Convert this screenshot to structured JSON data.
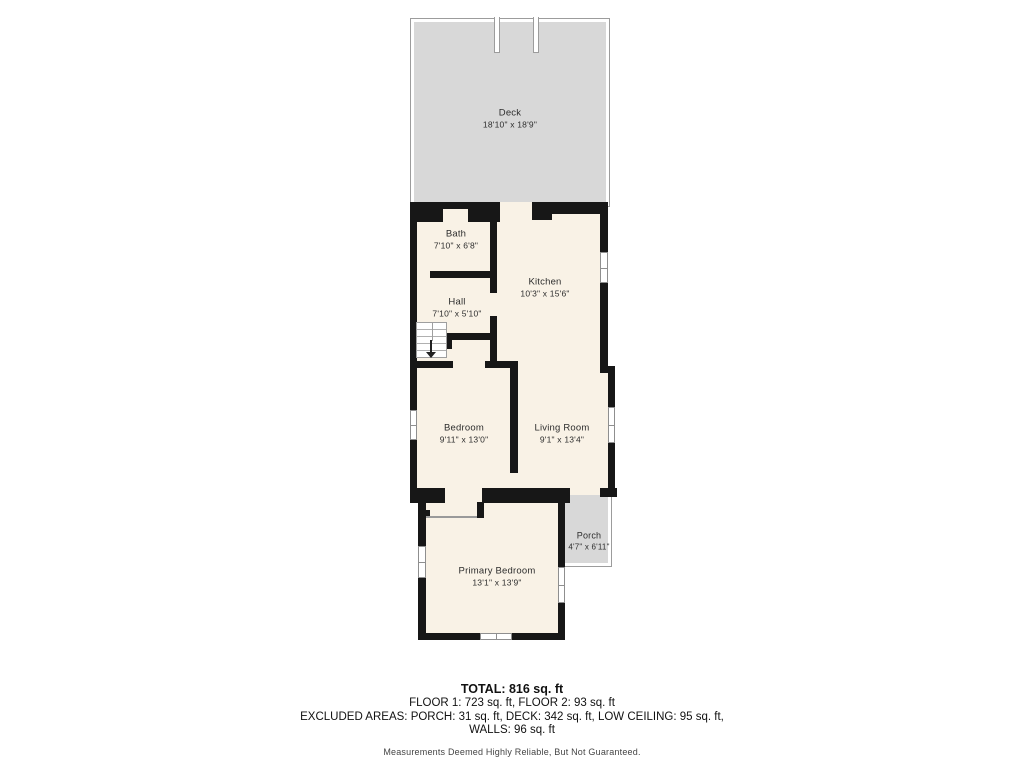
{
  "rooms": {
    "deck": {
      "name": "Deck",
      "dims": "18'10\" x 18'9\""
    },
    "bath": {
      "name": "Bath",
      "dims": "7'10\" x 6'8\""
    },
    "kitchen": {
      "name": "Kitchen",
      "dims": "10'3\" x 15'6\""
    },
    "hall": {
      "name": "Hall",
      "dims": "7'10\" x 5'10\""
    },
    "bedroom": {
      "name": "Bedroom",
      "dims": "9'11\" x 13'0\""
    },
    "living": {
      "name": "Living Room",
      "dims": "9'1\" x 13'4\""
    },
    "porch": {
      "name": "Porch",
      "dims": "4'7\" x 6'11\""
    },
    "primary": {
      "name": "Primary Bedroom",
      "dims": "13'1\" x 13'9\""
    }
  },
  "summary": {
    "total": "TOTAL: 816 sq. ft",
    "floors": "FLOOR 1: 723 sq. ft, FLOOR 2: 93 sq. ft",
    "excluded_line1": "EXCLUDED AREAS: PORCH: 31 sq. ft, DECK: 342 sq. ft, LOW CEILING: 95 sq. ft,",
    "excluded_line2": "WALLS: 96 sq. ft",
    "disclaimer": "Measurements Deemed Highly Reliable, But Not Guaranteed."
  },
  "colors": {
    "wall": "#171717",
    "floor": "#f9f2e6",
    "deck": "#d8d8d8",
    "outline": "#9c9c9c",
    "text": "#2d2d2d"
  }
}
